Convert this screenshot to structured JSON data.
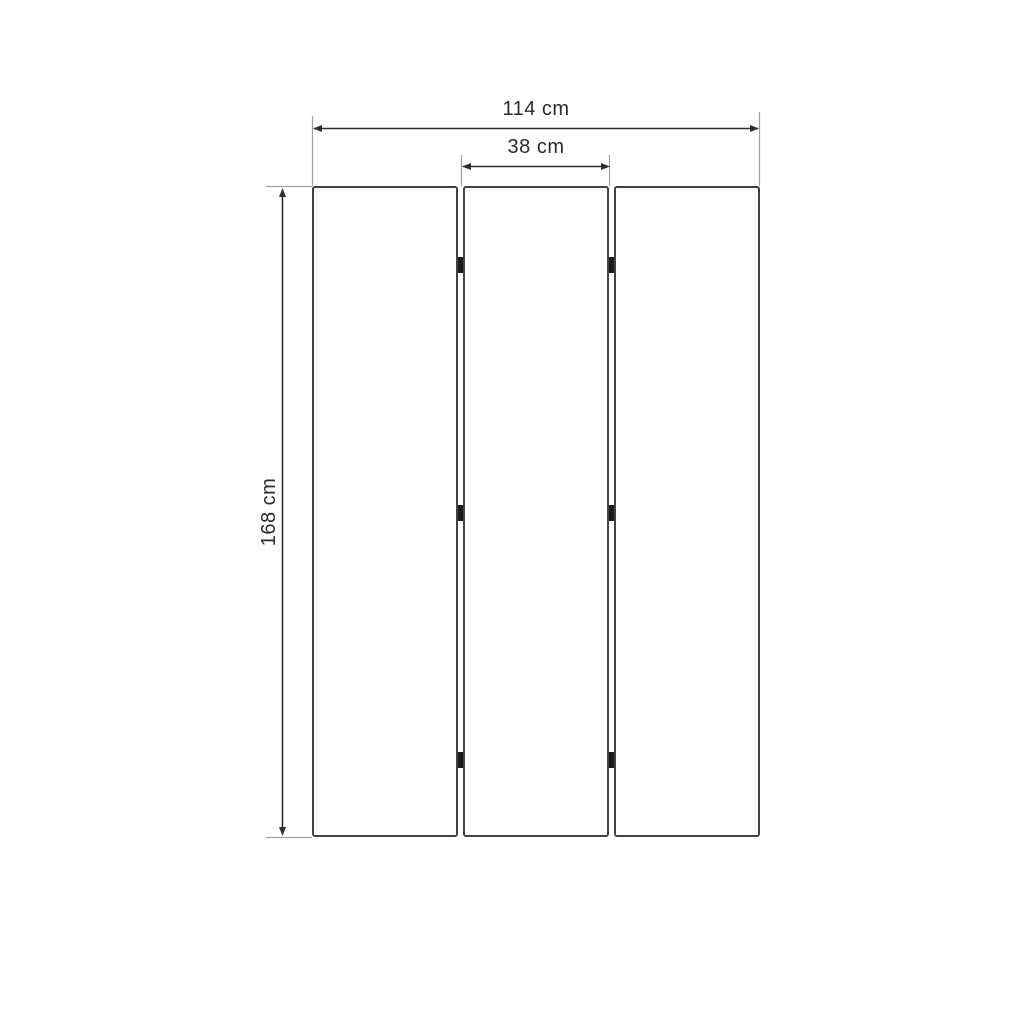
{
  "diagram": {
    "type": "dimension-drawing",
    "subject": "three-panel-folding-screen",
    "panel_count": 3,
    "hinge_count": 6,
    "labels": {
      "total_width": "114 cm",
      "panel_width": "38 cm",
      "height": "168 cm"
    },
    "values_cm": {
      "total_width": 114,
      "panel_width": 38,
      "height": 168
    }
  },
  "colors": {
    "background": "#ffffff",
    "dimension": "#2f2f2f",
    "extension": "#9e9e9e",
    "panel-stroke": "#424242",
    "panel-fill": "#ffffff",
    "hinge": "#1b1b1b",
    "text": "#2b2b2b"
  }
}
